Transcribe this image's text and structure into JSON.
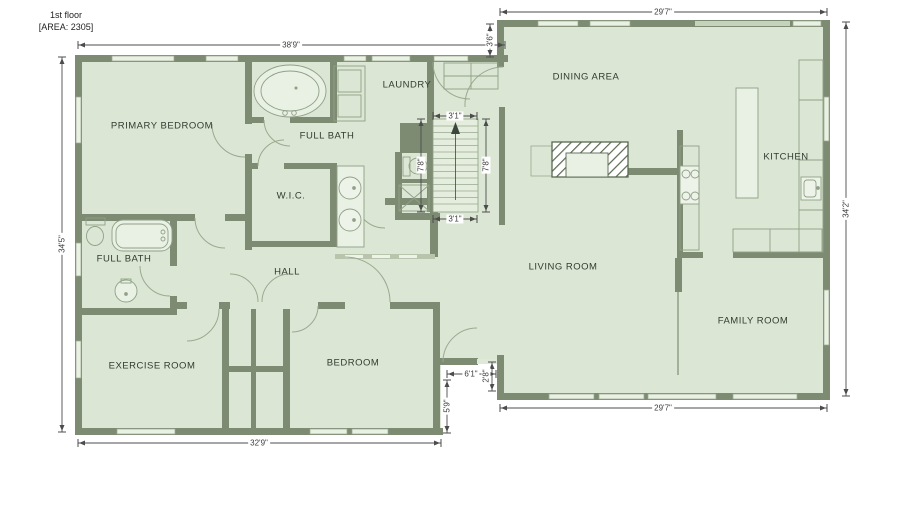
{
  "title": {
    "line1": "1st floor",
    "line2": "[AREA: 2305]",
    "floor_area": "2305"
  },
  "rooms": {
    "primary_bedroom": {
      "label": "PRIMARY BEDROOM"
    },
    "full_bath_top": {
      "label": "FULL BATH"
    },
    "laundry": {
      "label": "LAUNDRY"
    },
    "wic": {
      "label": "W.I.C."
    },
    "full_bath_left": {
      "label": "FULL BATH"
    },
    "hall": {
      "label": "HALL"
    },
    "exercise_room": {
      "label": "EXERCISE ROOM"
    },
    "bedroom": {
      "label": "BEDROOM"
    },
    "dining_area": {
      "label": "DINING AREA"
    },
    "kitchen": {
      "label": "KITCHEN"
    },
    "living_room": {
      "label": "LIVING ROOM"
    },
    "family_room": {
      "label": "FAMILY ROOM"
    }
  },
  "dimensions": {
    "top_left": "38'9\"",
    "top_right": "29'7\"",
    "dining_step": "3'6\"",
    "left_side": "34'5\"",
    "right_side": "34'2\"",
    "stairs_top": "3'1\"",
    "stairs_bottom": "3'1\"",
    "stairs_left": "7'8\"",
    "stairs_right": "7'8\"",
    "entry_width": "6'1\"",
    "entry_jog": "2'8\"",
    "entry_depth": "5'9\"",
    "bottom_left": "32'9\"",
    "bottom_right": "29'7\""
  },
  "colors": {
    "wall": "#7d8b73",
    "room_fill": "#dbe7d4",
    "window_fill": "#e9f0e4",
    "fixture_stroke": "#90a086",
    "dimension_line": "#4c4c4c",
    "label_text": "#333b31"
  }
}
